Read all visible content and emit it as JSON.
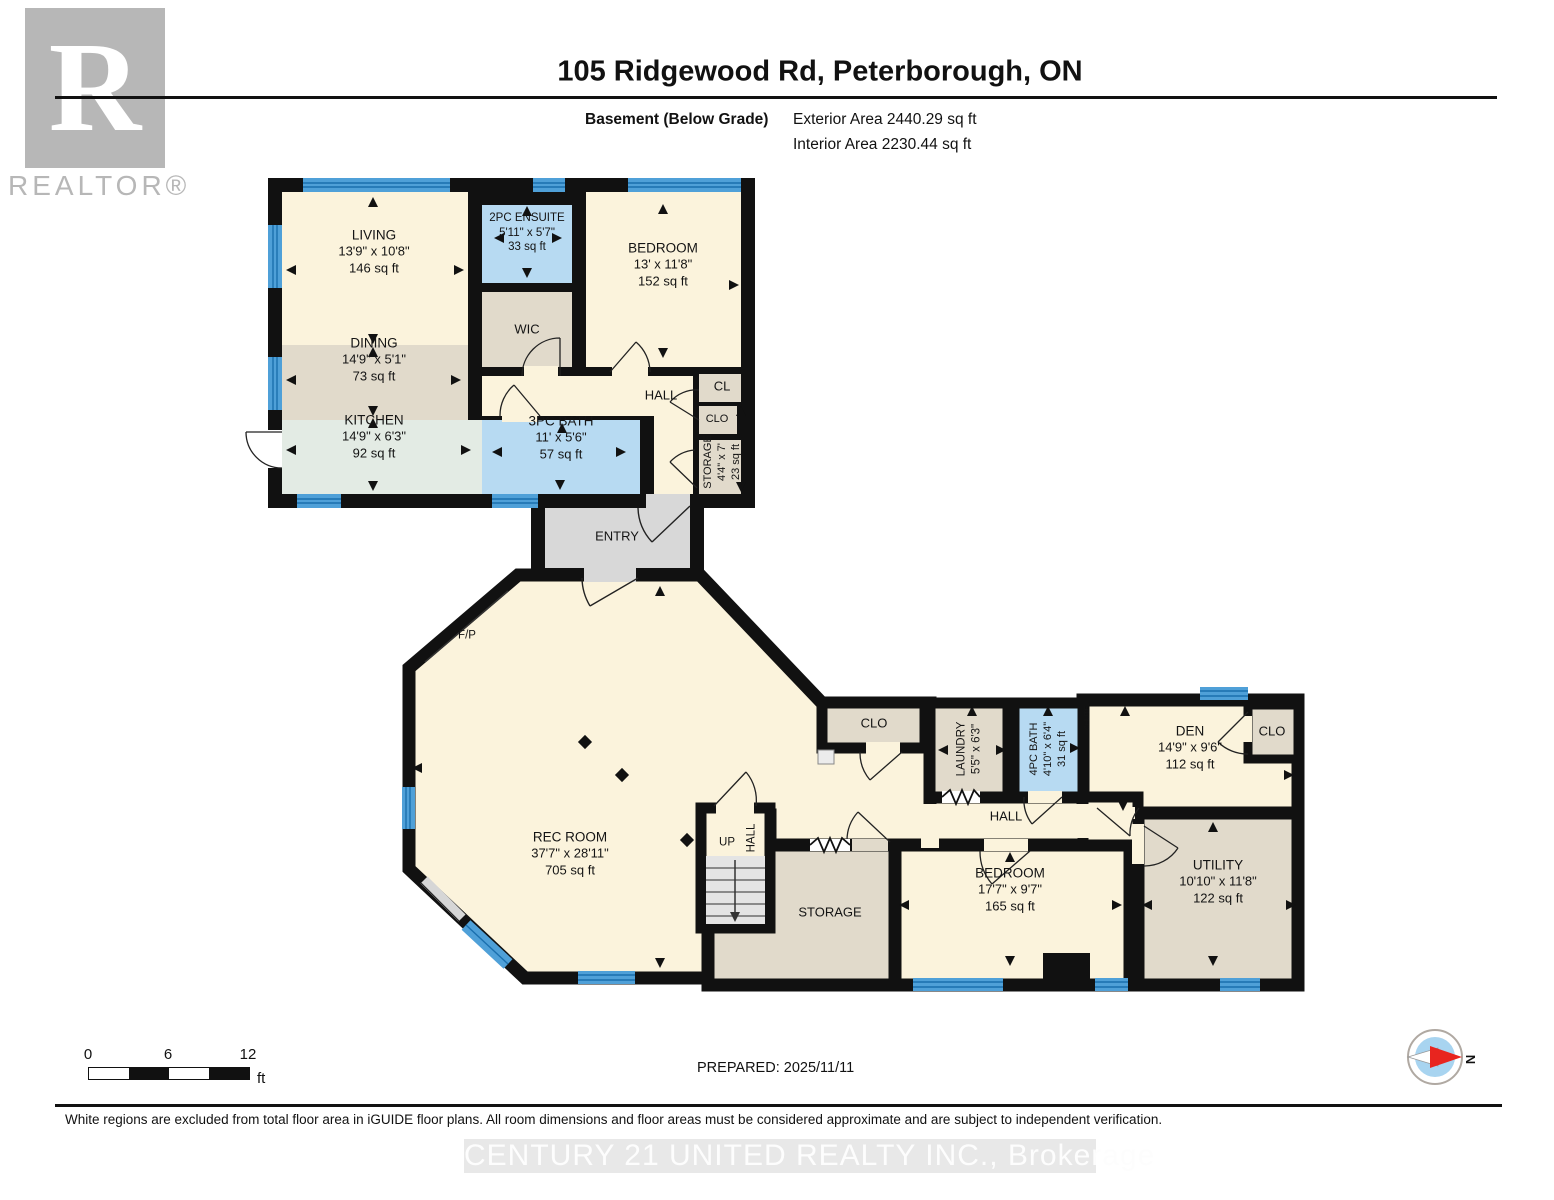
{
  "header": {
    "title": "105 Ridgewood Rd, Peterborough, ON",
    "floor_label": "Basement (Below Grade)",
    "exterior_area": "Exterior Area 2440.29 sq ft",
    "interior_area": "Interior Area 2230.44 sq ft",
    "logo_letter": "R",
    "logo_word": "REALTOR®"
  },
  "plan": {
    "rooms": [
      {
        "name": "LIVING",
        "dims": "13'9\" x 10'8\"",
        "area": "146 sq ft"
      },
      {
        "name": "2PC ENSUITE",
        "dims": "5'11\" x 5'7\"",
        "area": "33 sq ft"
      },
      {
        "name": "BEDROOM",
        "dims": "13' x 11'8\"",
        "area": "152 sq ft"
      },
      {
        "name": "WIC"
      },
      {
        "name": "DINING",
        "dims": "14'9\" x 5'1\"",
        "area": "73 sq ft"
      },
      {
        "name": "KITCHEN",
        "dims": "14'9\" x 6'3\"",
        "area": "92 sq ft"
      },
      {
        "name": "3PC BATH",
        "dims": "11' x 5'6\"",
        "area": "57 sq ft"
      },
      {
        "name": "HALL"
      },
      {
        "name": "CL"
      },
      {
        "name": "CLO"
      },
      {
        "name": "STORAGE",
        "dims": "4'4\" x 7'",
        "area": "23 sq ft"
      },
      {
        "name": "ENTRY"
      },
      {
        "name": "F/P"
      },
      {
        "name": "REC ROOM",
        "dims": "37'7\" x 28'11\"",
        "area": "705 sq ft"
      },
      {
        "name": "CLO"
      },
      {
        "name": "LAUNDRY",
        "dims": "5'5\" x 6'3\""
      },
      {
        "name": "4PC BATH",
        "dims": "4'10\" x 6'4\"",
        "area": "31 sq ft"
      },
      {
        "name": "CHUTE"
      },
      {
        "name": "DEN",
        "dims": "14'9\" x 9'6\"",
        "area": "112 sq ft"
      },
      {
        "name": "CLO"
      },
      {
        "name": "HALL"
      },
      {
        "name": "UP"
      },
      {
        "name": "HALL"
      },
      {
        "name": "STORAGE"
      },
      {
        "name": "BEDROOM",
        "dims": "17'7\" x 9'7\"",
        "area": "165 sq ft"
      },
      {
        "name": "UTILITY",
        "dims": "10'10\" x 11'8\"",
        "area": "122 sq ft"
      }
    ],
    "colors": {
      "wall": "#111111",
      "room_cream": "#FBF3DC",
      "room_tan": "#E1DACB",
      "room_mint": "#E3EBE4",
      "room_blue": "#B7DAF2",
      "window_blue": "#4FA0D8",
      "entry_gray": "#D8D8D8"
    }
  },
  "footer": {
    "scale": {
      "zero": "0",
      "six": "6",
      "twelve": "12",
      "unit": "ft"
    },
    "prepared": "PREPARED: 2025/11/11",
    "compass_n": "N",
    "disclaimer": "White regions are excluded from total floor area in iGUIDE floor plans. All room dimensions and floor areas must be considered approximate and are subject to independent verification.",
    "watermark": "CENTURY 21 UNITED REALTY INC., Brokerage"
  }
}
